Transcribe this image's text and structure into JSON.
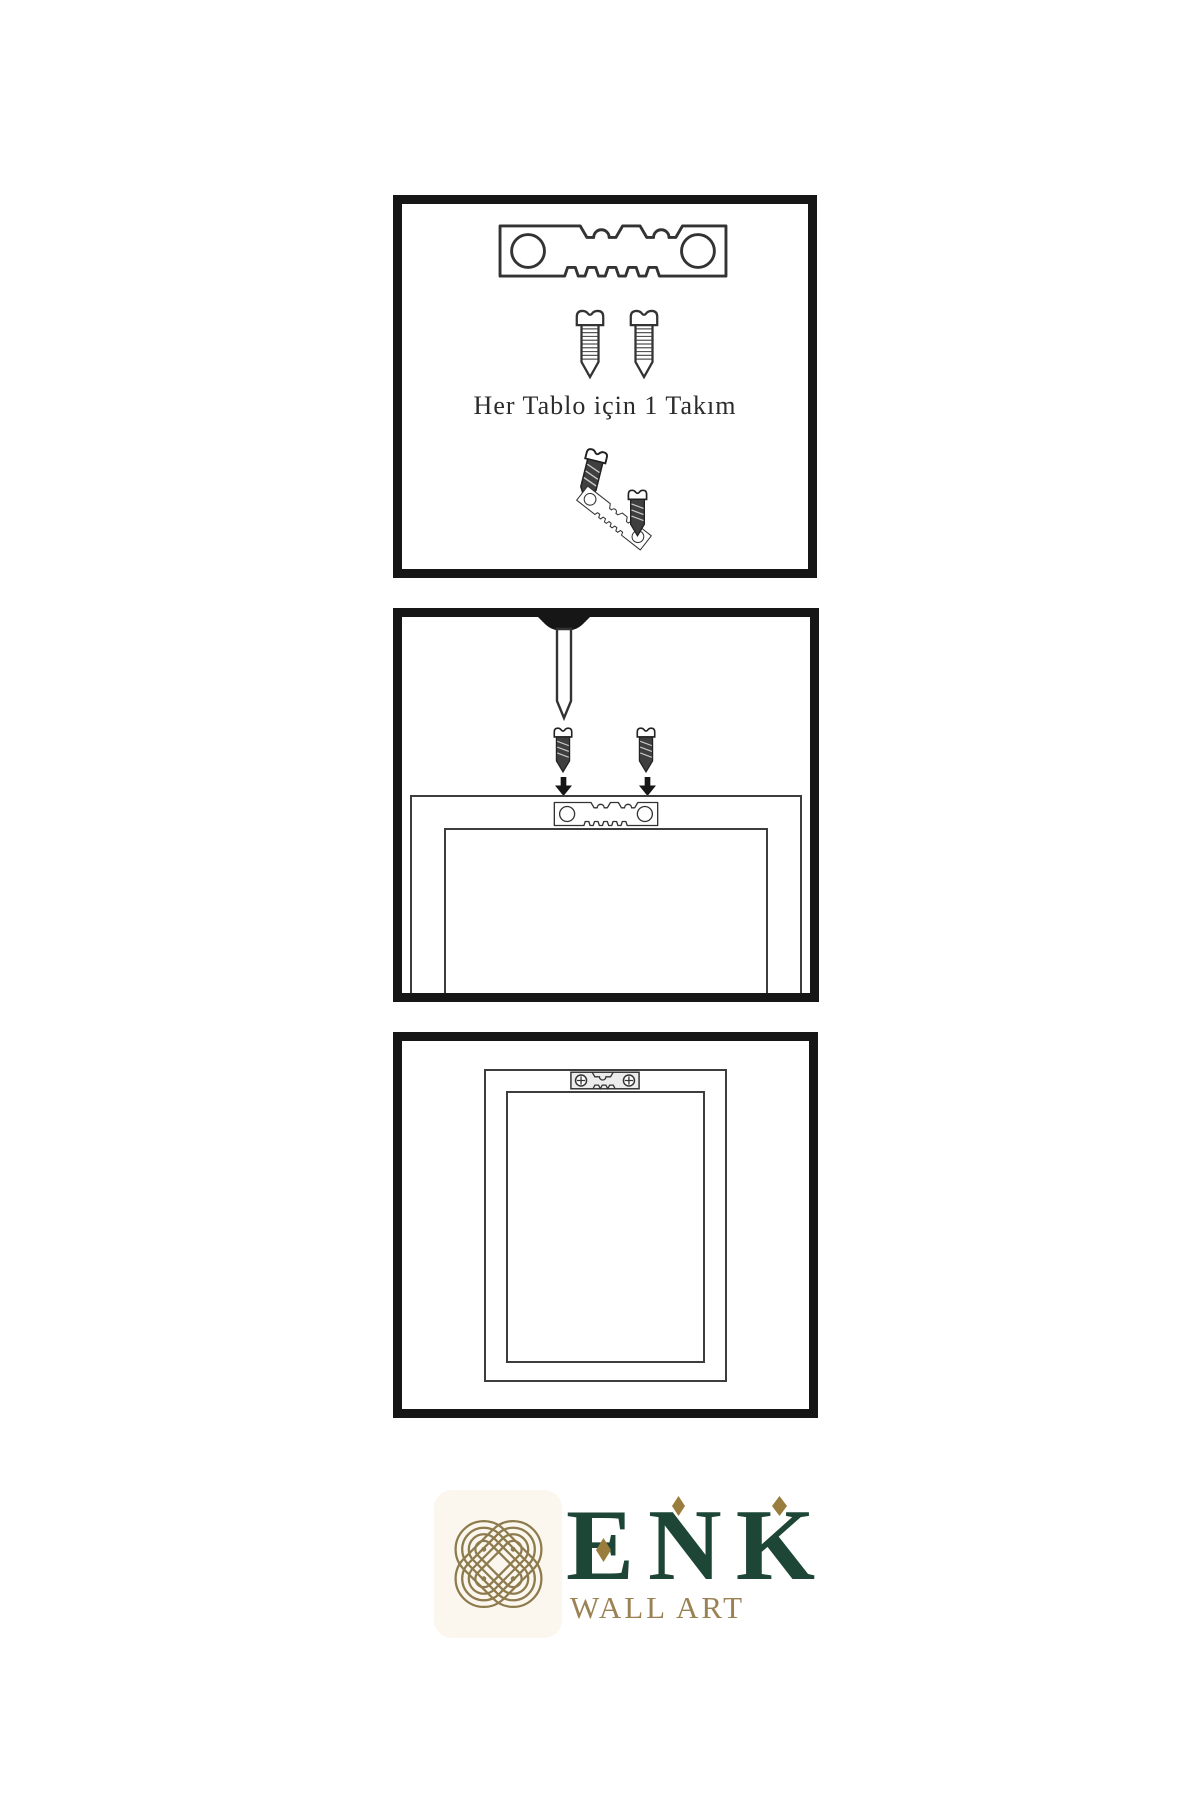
{
  "page": {
    "background_color": "#ffffff"
  },
  "steps": [
    {
      "name": "hardware-kit",
      "caption": "Her Tablo için 1 Takım",
      "items": [
        "sawtooth-hanger",
        "screw",
        "screw",
        "screws-into-tilted-hanger"
      ]
    },
    {
      "name": "attach-hanger-and-nail",
      "items": [
        "wall-nail",
        "screw",
        "screw",
        "down-arrow",
        "down-arrow",
        "frame-back-with-sawtooth-hanger"
      ]
    },
    {
      "name": "hang-frame-on-wall",
      "items": [
        "frame-front-with-mounted-sawtooth-hanger"
      ]
    }
  ],
  "brand": {
    "name": "ENK",
    "tagline": "WALL ART",
    "colors": {
      "logo_green": "#1d4636",
      "logo_gold": "#8d7b4e",
      "tagline_gold": "#9b8254",
      "diamond_gold": "#9a7c3c"
    }
  }
}
